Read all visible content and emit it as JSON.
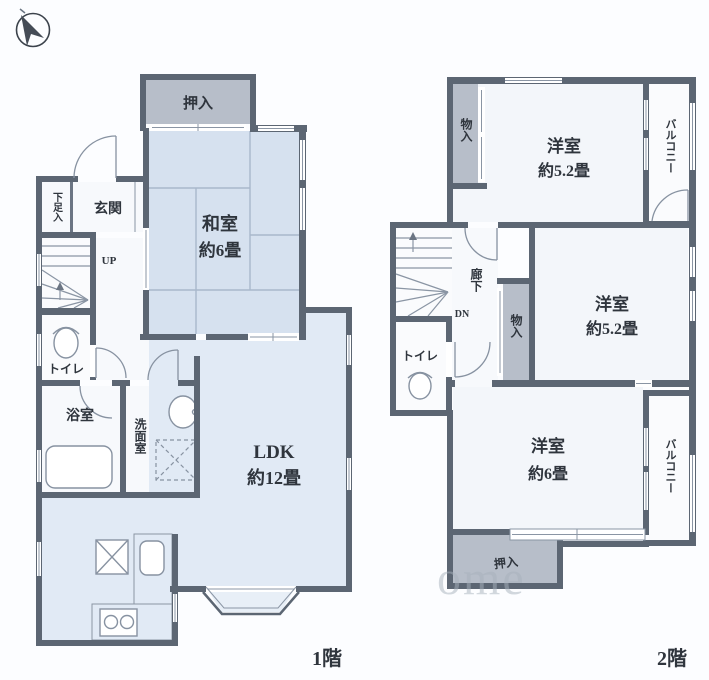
{
  "compass": {
    "icon": "north-arrow"
  },
  "floor1": {
    "title": "1階",
    "oshiire": "押入",
    "washitsu_name": "和室",
    "washitsu_size": "約6畳",
    "genkan": "玄関",
    "getabako": "下足入",
    "stairs_up": "UP",
    "toilet": "トイレ",
    "bath": "浴室",
    "washroom": "洗面室",
    "ldk_name": "LDK",
    "ldk_size": "約12畳"
  },
  "floor2": {
    "title": "2階",
    "storage_top": "物入",
    "room_top_name": "洋室",
    "room_top_size": "約5.2畳",
    "balcony_top": "バルコニー",
    "corridor": "廊下",
    "stairs_dn": "DN",
    "storage_mid": "物入",
    "room_mid_name": "洋室",
    "room_mid_size": "約5.2畳",
    "toilet": "トイレ",
    "room_bottom_name": "洋室",
    "room_bottom_size": "約6畳",
    "balcony_bottom": "バルコニー",
    "oshiire": "押入"
  },
  "watermark": "ome"
}
